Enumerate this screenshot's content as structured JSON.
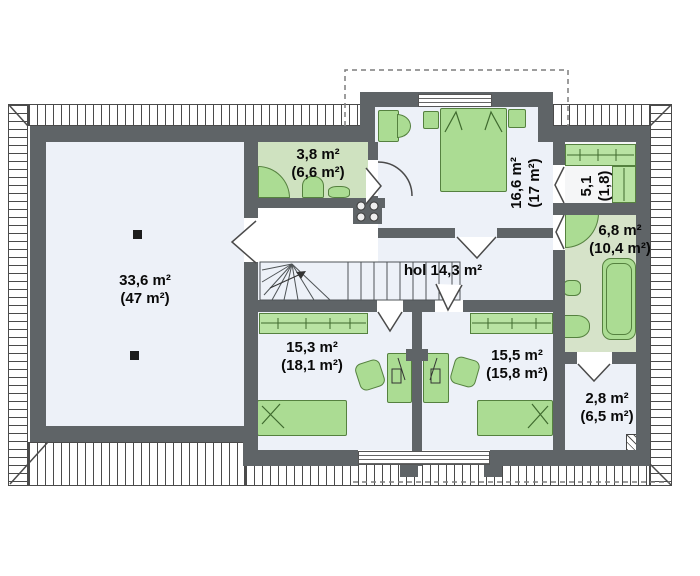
{
  "colors": {
    "wall": "#5f6467",
    "floor": "#edf1f8",
    "bath_floor": "#cfe2c0",
    "bath_floor_alt": "#d6e3c9",
    "wardrobe_floor": "#f5f6f7",
    "furniture": "#abdc93",
    "furniture_border": "#55813f",
    "closet": "#b9e3a3",
    "hatch": "#4a4a4a",
    "dash": "#7d7d7d",
    "text": "#0a0a0a"
  },
  "rooms": {
    "attic": {
      "area": "33,6 m²",
      "area_gross": "(47 m²)"
    },
    "bathroom_top": {
      "area": "3,8 m²",
      "area_gross": "(6,6 m²)"
    },
    "bedroom_top": {
      "area": "16,6 m²",
      "area_gross": "(17 m²)"
    },
    "wardrobe": {
      "area": "5,1",
      "area_gross": "(1,8)"
    },
    "bathroom_right": {
      "area": "6,8 m²",
      "area_gross": "(10,4 m²)"
    },
    "hall": {
      "label": "hol 14,3 m²"
    },
    "bedroom_left": {
      "area": "15,3 m²",
      "area_gross": "(18,1 m²)"
    },
    "bedroom_right": {
      "area": "15,5 m²",
      "area_gross": "(15,8 m²)"
    },
    "storage": {
      "area": "2,8 m²",
      "area_gross": "(6,5 m²)"
    }
  }
}
